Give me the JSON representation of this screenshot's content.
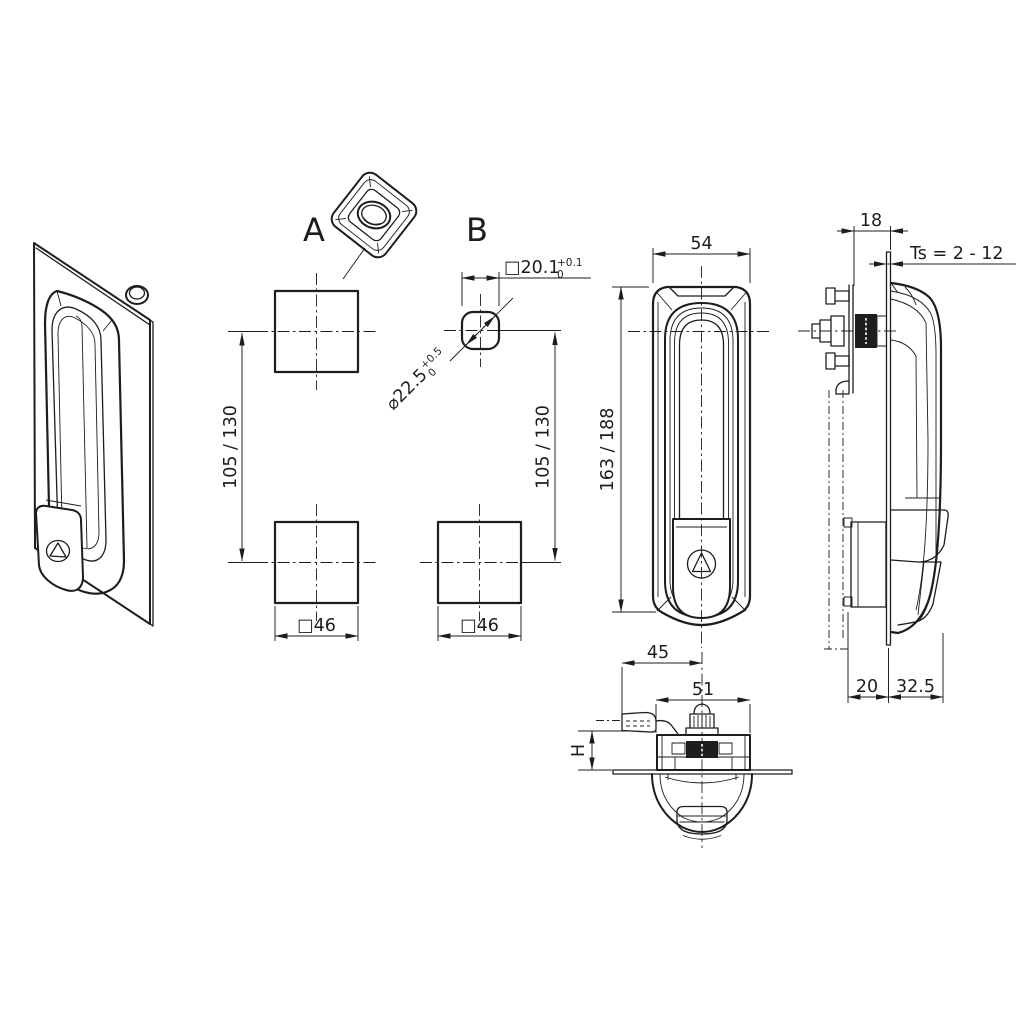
{
  "meta": {
    "background": "#ffffff",
    "ink": "#1d1d1d"
  },
  "labels": {
    "detail_a": "A",
    "detail_b": "B"
  },
  "dims": {
    "square_cutout": "□20.1",
    "square_cutout_tol_up": "+0.1",
    "square_cutout_tol_dn": "0",
    "corner_diameter": "⌀22.5",
    "corner_diameter_tol_up": "+0.5",
    "corner_diameter_tol_dn": "0",
    "hole_spacing": "105 / 130",
    "cutout_square_size": "□46",
    "handle_width": "54",
    "handle_length": "163 / 188",
    "protrusion": "18",
    "door_thickness_range": "Ts = 2 - 12",
    "depth_behind_door": "20",
    "depth_front": "32.5",
    "cam_offset": "45",
    "base_width": "51",
    "cam_height": "H"
  }
}
